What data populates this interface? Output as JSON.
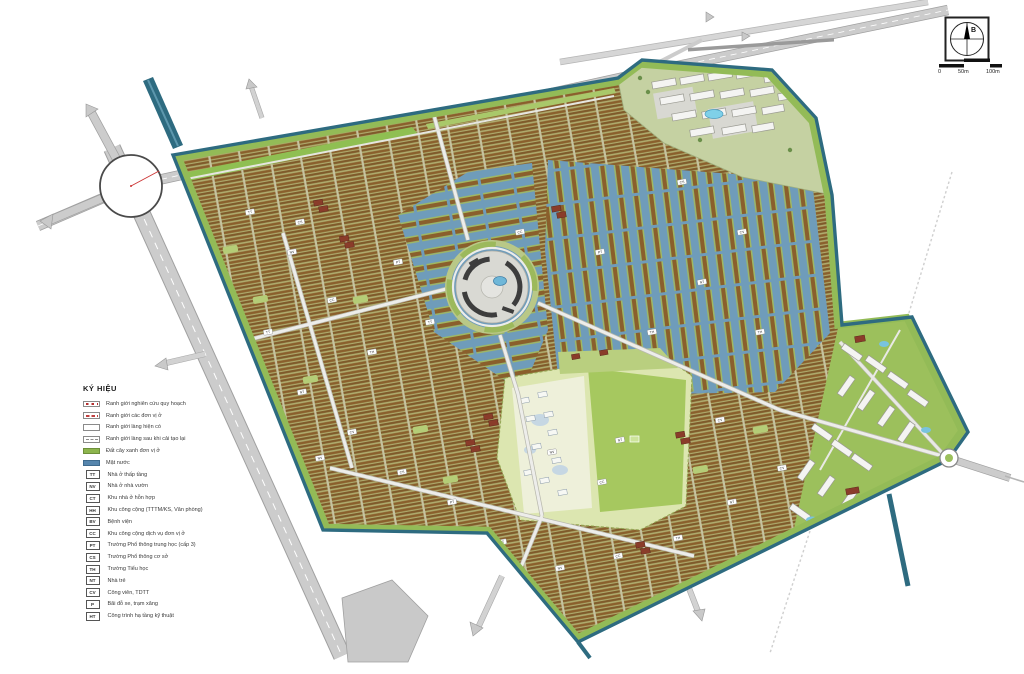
{
  "legend": {
    "title": "KÝ HIỆU",
    "boundary_items": [
      {
        "swatch": "red-squares",
        "label": "Ranh giới nghiên cứu quy hoạch"
      },
      {
        "swatch": "red-dashes",
        "label": "Ranh giới các đơn vị ở"
      },
      {
        "swatch": "plain-box",
        "label": "Ranh giới làng hiện có"
      },
      {
        "swatch": "dashed-box",
        "label": "Ranh giới làng sau khi cải tạo lại"
      },
      {
        "swatch": "green-fill",
        "label": "Đất cây xanh đơn vị ở",
        "color": "#8db54d"
      },
      {
        "swatch": "blue-fill",
        "label": "Mặt nước",
        "color": "#5585ad"
      }
    ],
    "code_items": [
      {
        "code": "TT",
        "label": "Nhà ở thấp tầng"
      },
      {
        "code": "NV",
        "label": "Nhà ở nhà vườn"
      },
      {
        "code": "CT",
        "label": "Khu nhà ở hỗn hợp"
      },
      {
        "code": "HH",
        "label": "Khu công cộng (TTTM/KS, Văn phòng)"
      },
      {
        "code": "BV",
        "label": "Bệnh viện"
      },
      {
        "code": "CC",
        "label": "Khu công cộng dịch vụ đơn vị ở"
      },
      {
        "code": "PT",
        "label": "Trường Phổ thông trung học (cấp 3)"
      },
      {
        "code": "CS",
        "label": "Trường Phổ thông cơ sở"
      },
      {
        "code": "TH",
        "label": "Trường Tiểu học"
      },
      {
        "code": "NT",
        "label": "Nhà trẻ"
      },
      {
        "code": "CV",
        "label": "Công viên, TDTT"
      },
      {
        "code": "P",
        "label": "Bãi đỗ xe, trạm xăng"
      },
      {
        "code": "HT",
        "label": "Công trình hạ tầng kỹ thuật"
      }
    ]
  },
  "compass": {
    "north_label": "B"
  },
  "scale_bar": {
    "labels": [
      "0",
      "50m",
      "100m"
    ]
  },
  "map": {
    "colors": {
      "water": "#6f9cba",
      "canal": "#2e6b80",
      "housing_row": "#8a5f2c",
      "green_area": "#9cc05c",
      "road": "#cccccc",
      "red_roof": "#8a3c2a",
      "pool": "#7fd0e8"
    },
    "parcel_codes": [
      "TT",
      "NV",
      "CC",
      "TH",
      "NT",
      "CV",
      "CS",
      "PT"
    ]
  }
}
